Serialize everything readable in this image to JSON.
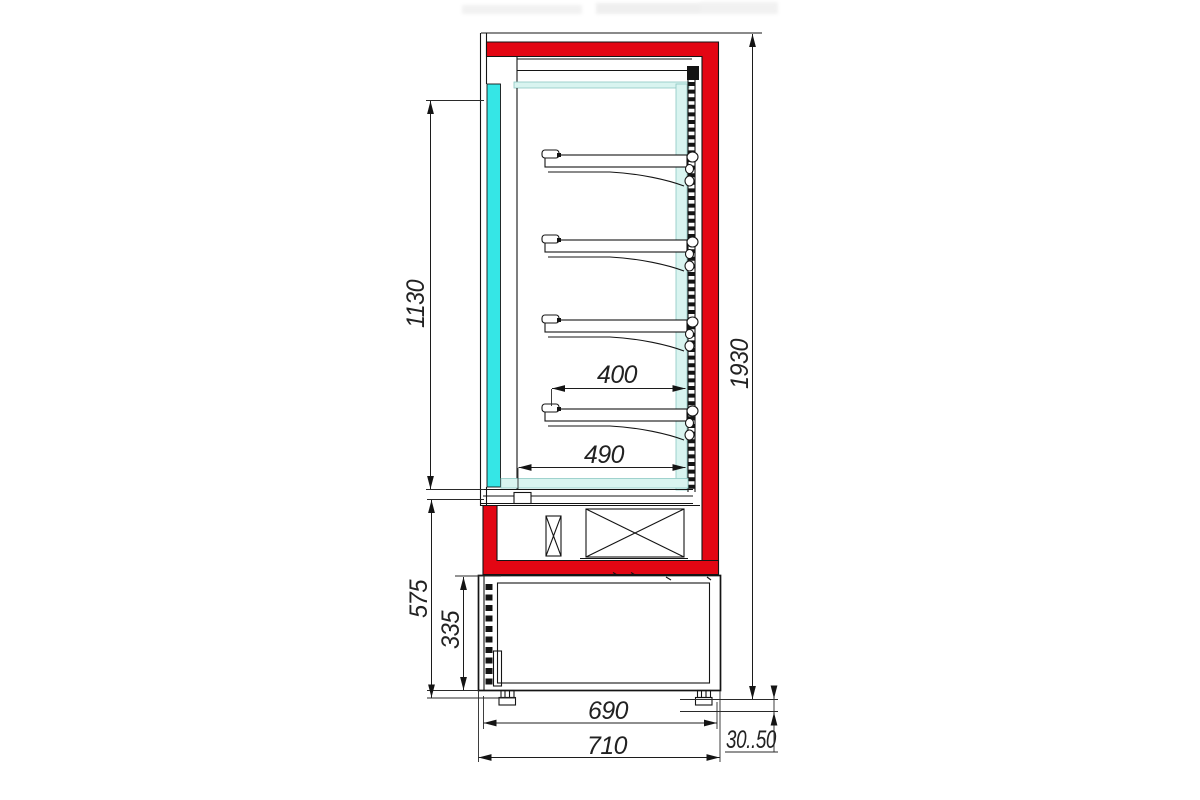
{
  "drawing": {
    "type": "technical-drawing",
    "subject": "refrigerated-display-case-side-section",
    "view": "side cross-section with dimensions (mm)",
    "shelf_count": 4,
    "dims": {
      "h_interior": "1130",
      "h_overall": "1930",
      "d_shelf": "400",
      "d_interior": "490",
      "h_base_section": "575",
      "h_machine_compartment": "335",
      "d_body": "690",
      "d_overall": "710",
      "leg_adjust_range": "30..50"
    }
  },
  "colors": {
    "accent_red": "#e30613",
    "glass_cyan": "#35e6e6",
    "duct_cyan": "#d9f4f0",
    "line": "#141414",
    "background": "#ffffff"
  }
}
